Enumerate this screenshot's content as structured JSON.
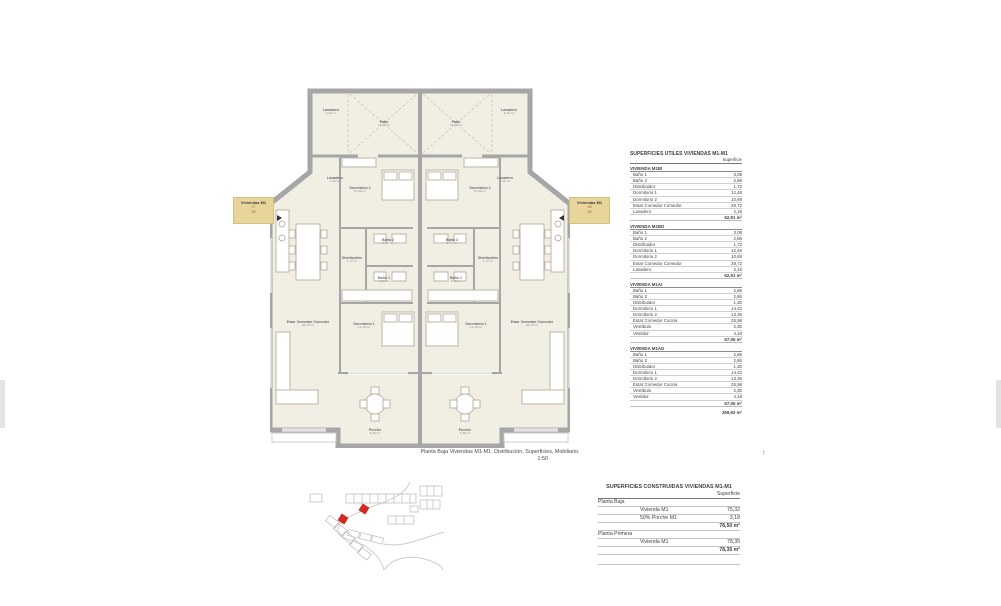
{
  "page": {
    "caption_line1": "Planta Baja Viviendas M1-M1. Distribución, Superficies, Mobiliario.",
    "caption_line2": "1:50",
    "stray_mark": "f"
  },
  "colors": {
    "wall_gray": "#a6a6a6",
    "room_cream": "#f1eee4",
    "label_yellow": "#e8d59c",
    "red_number": "#b8502c",
    "map_red": "#cf2b24",
    "furniture_line": "#bdb6a6"
  },
  "side_labels": {
    "left": {
      "title": "Viviendas M1",
      "line1": "17",
      "line2": "25"
    },
    "right": {
      "title": "Viviendas M1",
      "line1": "18",
      "line2": "26"
    }
  },
  "plan": {
    "rooms": {
      "lavadero_top": {
        "name": "Lavadero",
        "area": "4,20 m²"
      },
      "patio": {
        "name": "Patio",
        "area": "14,52 m²"
      },
      "lavadero_side": {
        "name": "Lavadero",
        "area": "2,18 m²"
      },
      "dormitorio2": {
        "name": "Dormitorio 2",
        "area": "10,69 m²"
      },
      "bano2": {
        "name": "Baño 2",
        "area": "2,86 m²"
      },
      "distribuidor": {
        "name": "Distribuidor",
        "area": "1,72 m²"
      },
      "bano1": {
        "name": "Baño 1",
        "area": "3,08 m²"
      },
      "dormitorio1": {
        "name": "Dormitorio 1",
        "area": "12,48 m²"
      },
      "estar": {
        "name": "Estar Comedor Comedor",
        "area": "28,72 m²"
      },
      "porche": {
        "name": "Porche",
        "area": "6,36 m²"
      }
    }
  },
  "tables": {
    "utiles": {
      "title": "SUPERFICIES UTILES VIVIENDAS M1-M1",
      "col_header": "Superficie",
      "blocks": [
        {
          "name": "VIVIENDA M1BI",
          "rows": [
            [
              "Baño 1",
              "3,08"
            ],
            [
              "Baño 2",
              "2,86"
            ],
            [
              "Distribuidor",
              "1,72"
            ],
            [
              "Dormitorio 1",
              "12,48"
            ],
            [
              "Dormitorio 2",
              "10,69"
            ],
            [
              "Estar Comedor Comedor",
              "28,72"
            ],
            [
              "Lavadero",
              "2,18"
            ]
          ],
          "total": "62,91 m²"
        },
        {
          "name": "VIVIENDA M1BD",
          "rows": [
            [
              "Baño 1",
              "3,08"
            ],
            [
              "Baño 2",
              "2,86"
            ],
            [
              "Distribuidor",
              "1,72"
            ],
            [
              "Dormitorio 1",
              "12,48"
            ],
            [
              "Dormitorio 2",
              "10,69"
            ],
            [
              "Estar Comedor Comedor",
              "28,72"
            ],
            [
              "Lavadero",
              "2,18"
            ]
          ],
          "total": "62,91 m²"
        },
        {
          "name": "VIVIENDA M1AI",
          "rows": [
            [
              "Baño 1",
              "2,86"
            ],
            [
              "Baño 2",
              "2,86"
            ],
            [
              "Distribuidor",
              "1,30"
            ],
            [
              "Dormitorio 1",
              "14,22"
            ],
            [
              "Dormitorio 2",
              "13,35"
            ],
            [
              "Estar Comedor Cocina",
              "25,98"
            ],
            [
              "Vestíbulo",
              "2,30"
            ],
            [
              "Vestidor",
              "4,18"
            ]
          ],
          "total": "67,05 m²"
        },
        {
          "name": "VIVIENDA M1AD",
          "rows": [
            [
              "Baño 1",
              "2,86"
            ],
            [
              "Baño 2",
              "2,86"
            ],
            [
              "Distribuidor",
              "1,30"
            ],
            [
              "Dormitorio 1",
              "14,22"
            ],
            [
              "Dormitorio 2",
              "13,35"
            ],
            [
              "Estar Comedor Cocina",
              "25,98"
            ],
            [
              "Vestíbulo",
              "2,30"
            ],
            [
              "Vestidor",
              "4,18"
            ]
          ],
          "total": "67,05 m²"
        }
      ],
      "grand_total": "259,92 m²"
    },
    "construidas": {
      "title": "SUPERFICIES CONSTRUIDAS VIVIENDAS M1-M1",
      "col_header": "Superficie",
      "sections": [
        {
          "name": "Planta Baja",
          "rows": [
            [
              "Vivienda M1",
              "75,32"
            ],
            [
              "50% Porche M1",
              "3,18"
            ]
          ],
          "total": "78,50 m²"
        },
        {
          "name": "Planta Primera",
          "rows": [
            [
              "Vivienda M1",
              "78,35"
            ]
          ],
          "total": "78,35 m²"
        }
      ]
    }
  }
}
